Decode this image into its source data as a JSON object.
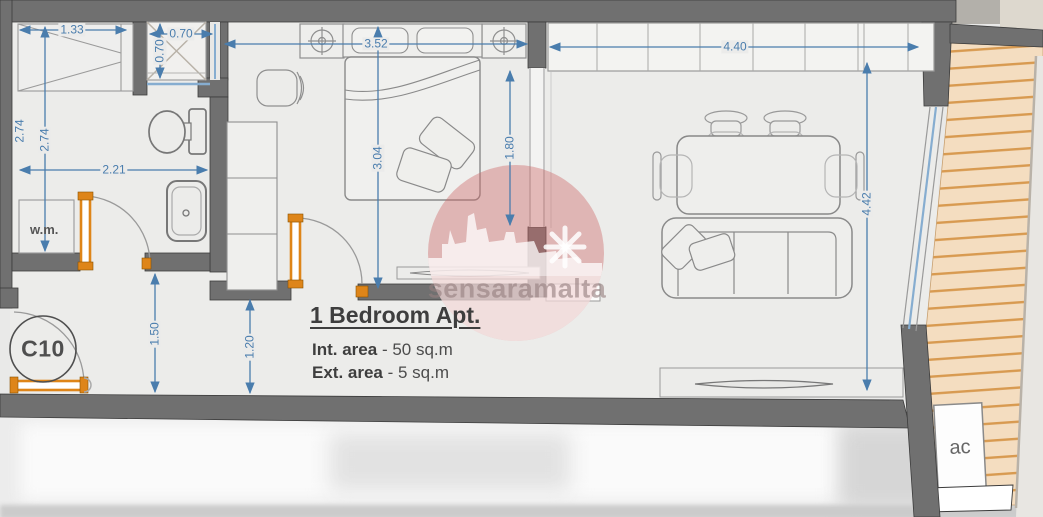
{
  "plan": {
    "title": "1 Bedroom Apt.",
    "interior_area_label": "Int. area",
    "interior_area_value": "- 50 sq.m",
    "exterior_area_label": "Ext. area",
    "exterior_area_value": "- 5 sq.m",
    "unit_number": "C10",
    "watermark": "sensaramalta"
  },
  "labels": {
    "washing_machine": "w.m.",
    "air_conditioning": "ac"
  },
  "dimensions": {
    "closet_width": "1.33",
    "shower_width": "0.70",
    "shower_depth": "0.70",
    "left_height": "2.74",
    "left_height_partial": "2.74",
    "bathroom_width": "2.21",
    "bedroom_width": "3.52",
    "bedroom_length": "3.04",
    "opening_width": "1.80",
    "kitchen_width": "4.40",
    "living_length": "4.42",
    "hall_width": "1.50",
    "hall_depth": "1.20"
  },
  "colors": {
    "wall": "#707070",
    "dimension": "#4a7dad",
    "door": "#de8519",
    "decking": "#f4ddc0",
    "watermark_red": "#cd6a6a"
  }
}
